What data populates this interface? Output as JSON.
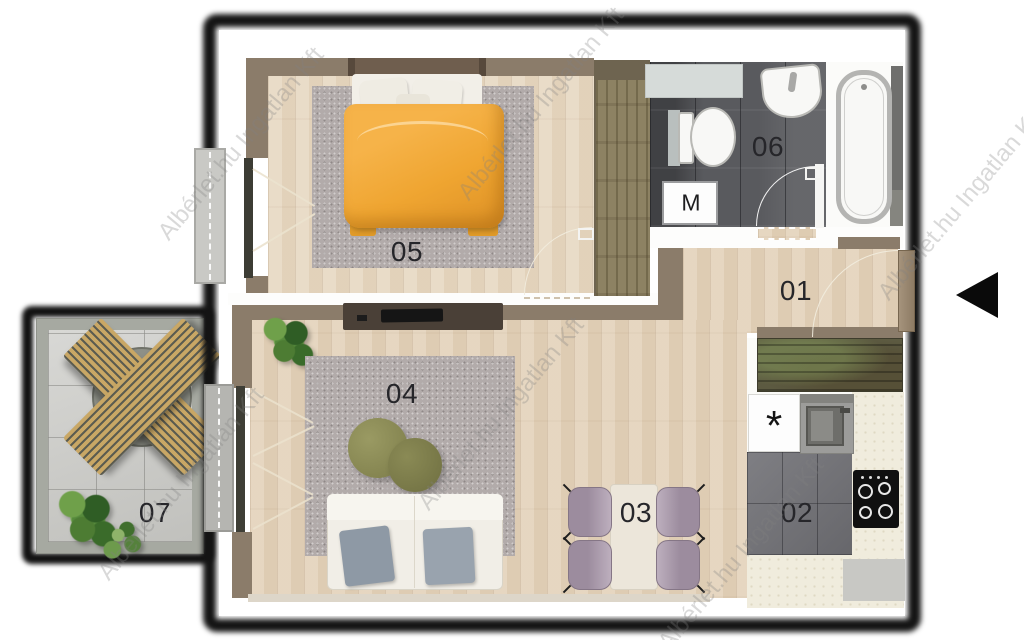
{
  "floorplan": {
    "watermark_text": "Albérlet.hu Ingatlan Kft",
    "rooms": [
      {
        "number": "01",
        "name": "hallway"
      },
      {
        "number": "02",
        "name": "kitchen"
      },
      {
        "number": "03",
        "name": "dining-area"
      },
      {
        "number": "04",
        "name": "living-room"
      },
      {
        "number": "05",
        "name": "bedroom"
      },
      {
        "number": "06",
        "name": "bathroom"
      },
      {
        "number": "07",
        "name": "balcony"
      }
    ],
    "appliances": {
      "washing_machine": "M",
      "refrigerator": "*"
    },
    "icons": {
      "entrance_arrow": "left-pointing-triangle"
    },
    "colors": {
      "bed_duvet": "#efa531",
      "dining_chairs": "#a795a7",
      "wood_floor": "#e3d2ba",
      "rug": "#b2abaa",
      "wall": "#8b7c6a",
      "bathroom_floor": "#595a5e",
      "kitchen_floor": "#75757a",
      "balcony_tile": "#cbcbc7",
      "kitchen_counter": "#5c5a41",
      "outline": "#141414"
    }
  }
}
